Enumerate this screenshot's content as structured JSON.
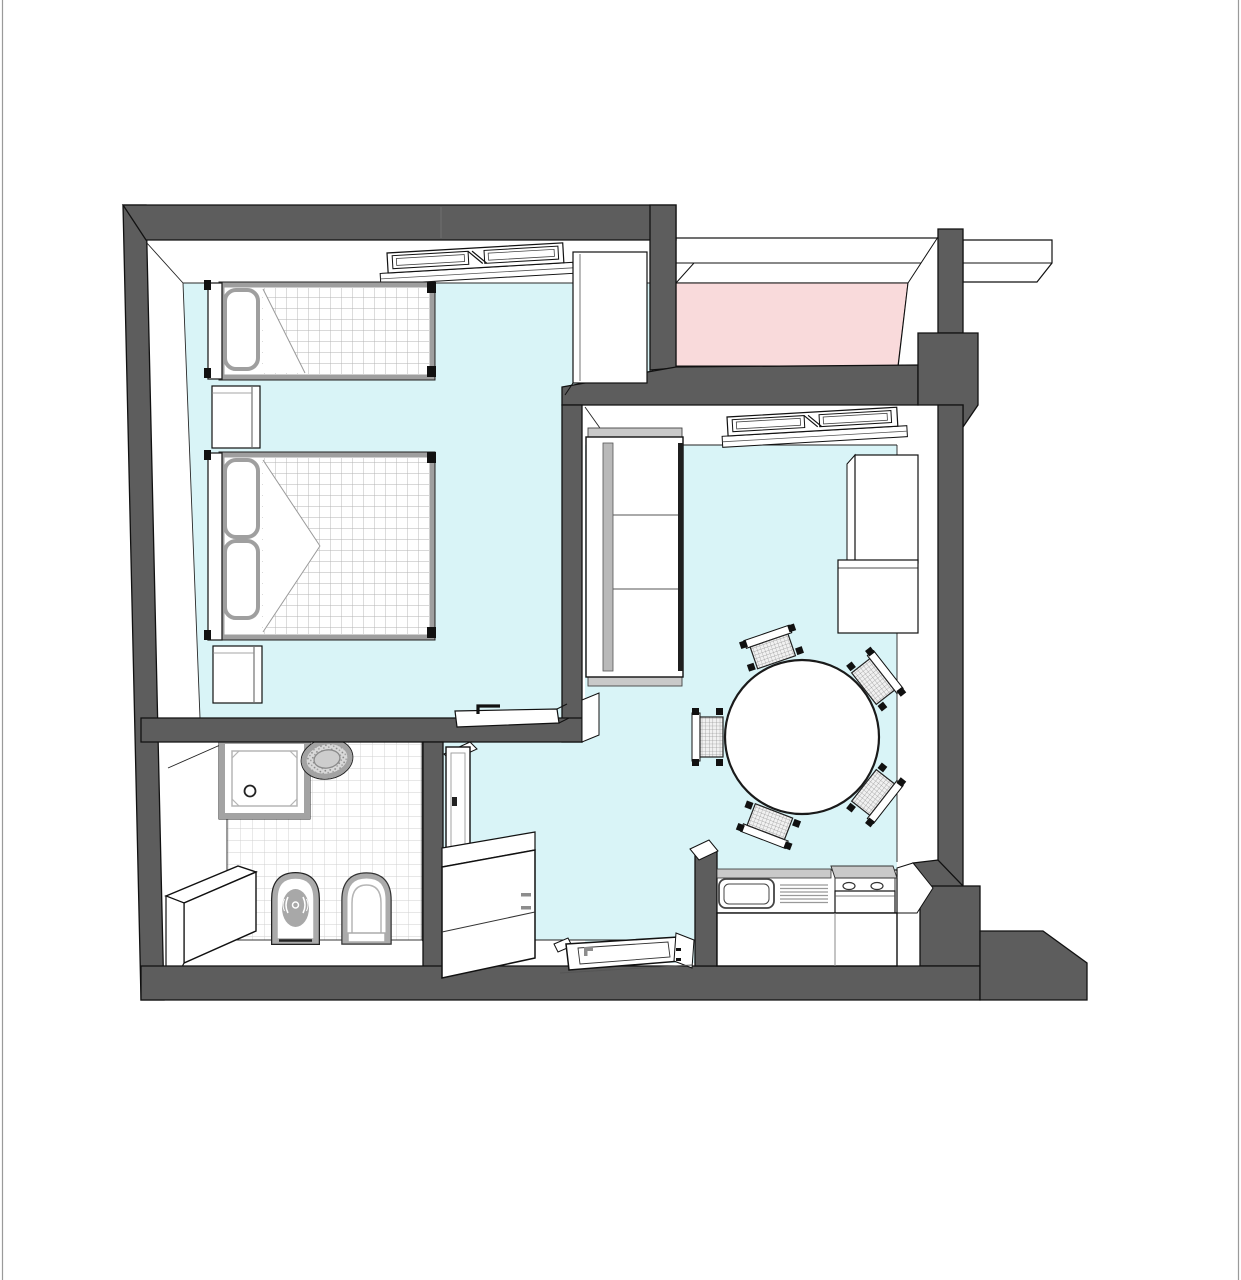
{
  "diagram": {
    "type": "floor-plan",
    "view": "3d-overhead-perspective",
    "colors": {
      "bg": "#ffffff",
      "wall": "#5d5d5d",
      "outline": "#111111",
      "floor": "#d9f4f7",
      "balcony": "#f9dadb",
      "fixture": "#a3a3a3",
      "bedframe": "#9f9f9f",
      "cap": "#c9c9c9",
      "tile-line": "#cfcfcf",
      "check-line": "#b3b3b3"
    },
    "rooms": [
      {
        "name": "bedroom",
        "floor": "cyan",
        "furniture": [
          "single-bed",
          "double-bed",
          "nightstand-1",
          "nightstand-2",
          "wardrobe",
          "casement-window",
          "open-door"
        ]
      },
      {
        "name": "living-room",
        "floor": "cyan",
        "furniture": [
          "three-seat-sofa",
          "round-dining-table",
          "dining-chairs",
          "tall-cabinet",
          "side-desk",
          "casement-window"
        ]
      },
      {
        "name": "kitchen-corner",
        "floor": "cyan",
        "furniture": [
          "counter-with-sink",
          "drainer",
          "cooktop-stove",
          "half-wall"
        ]
      },
      {
        "name": "hallway",
        "floor": "cyan",
        "furniture": [
          "refrigerator-cabinet",
          "bathroom-door",
          "entrance-door"
        ]
      },
      {
        "name": "bathroom",
        "floor": "white-tiles",
        "furniture": [
          "shower-tray",
          "round-washbasin",
          "bidet",
          "toilet",
          "corner-block"
        ]
      },
      {
        "name": "balcony",
        "floor": "pink",
        "furniture": [
          "parapet",
          "outer-ledge"
        ]
      }
    ],
    "counts": {
      "dining_chairs": 5,
      "beds": 2,
      "windows": 2,
      "doors": 3,
      "sanitary_fixtures": 4
    }
  }
}
